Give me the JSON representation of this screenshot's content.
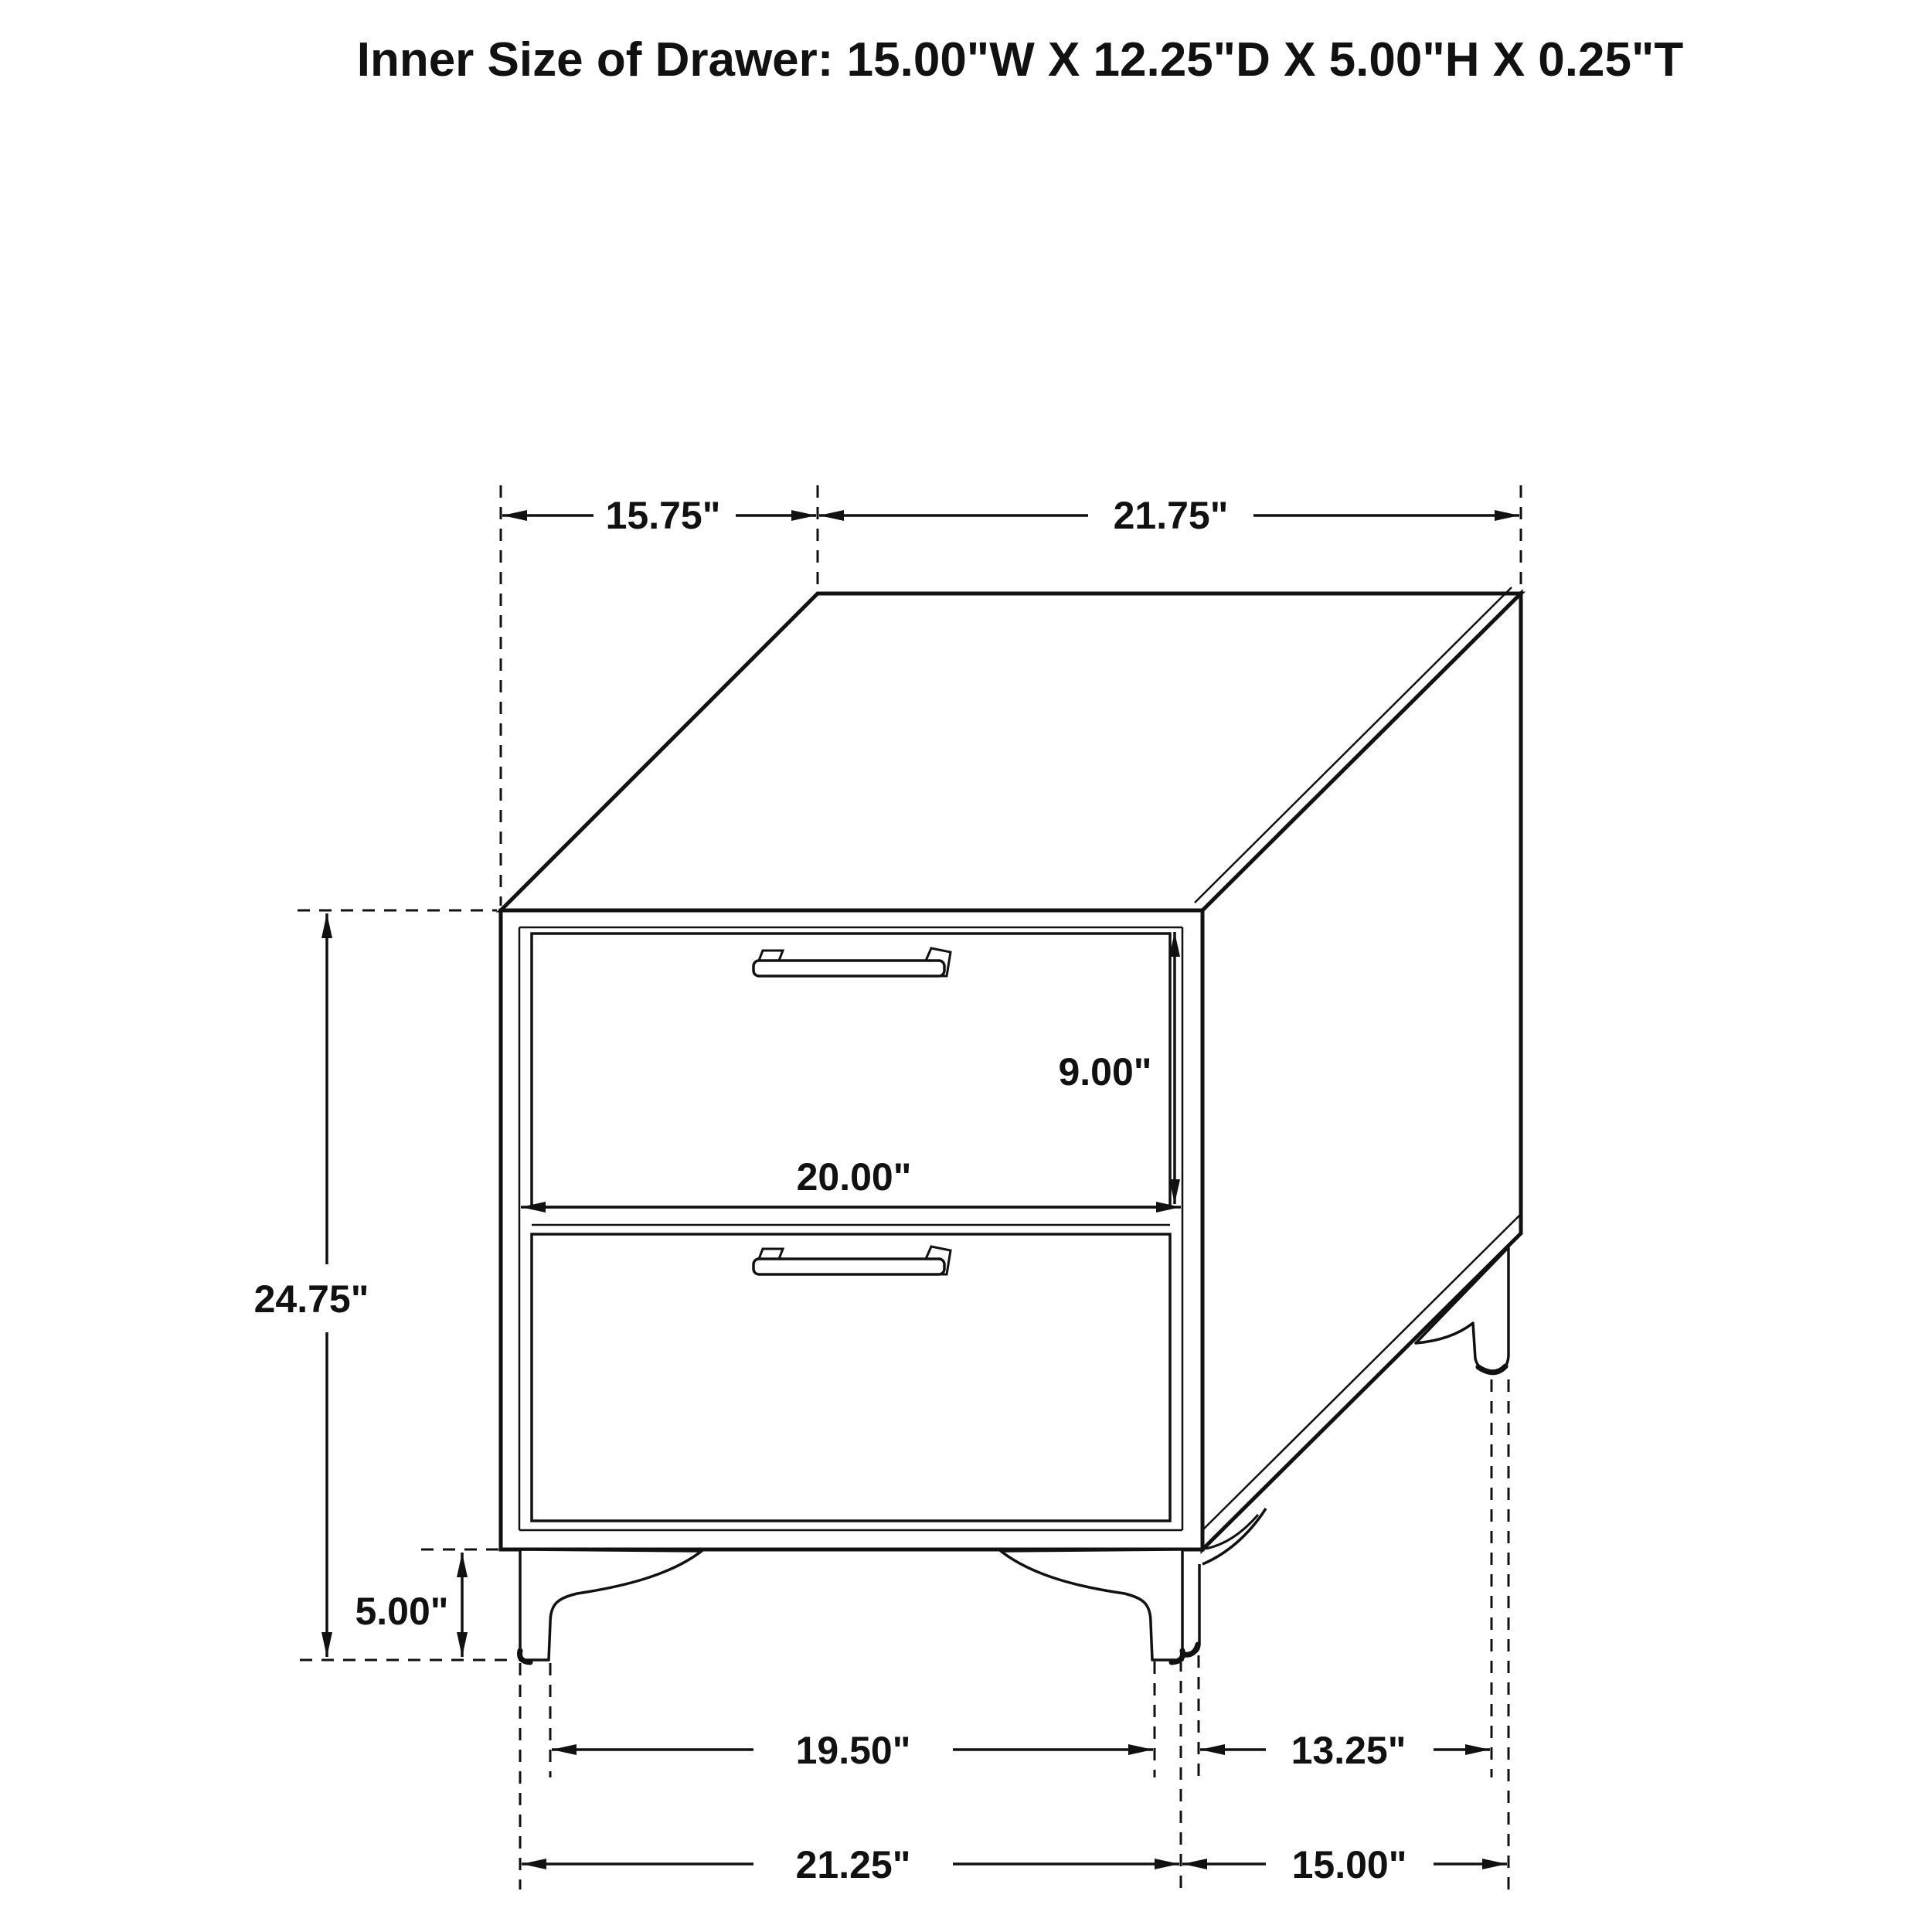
{
  "title": "Inner Size of Drawer: 15.00\"W X 12.25\"D X 5.00\"H X 0.25\"T",
  "dimensions": {
    "top_depth": "15.75\"",
    "top_width": "21.75\"",
    "overall_height": "24.75\"",
    "opening_height": "9.00\"",
    "drawer_width": "20.00\"",
    "leg_height": "5.00\"",
    "front_feet_inner_span": "19.50\"",
    "side_feet_inner_span": "13.25\"",
    "overall_width": "21.25\"",
    "overall_depth": "15.00\""
  },
  "drawing": {
    "object": "2-drawer nightstand",
    "line_color": "#111111",
    "background_color": "#ffffff"
  }
}
